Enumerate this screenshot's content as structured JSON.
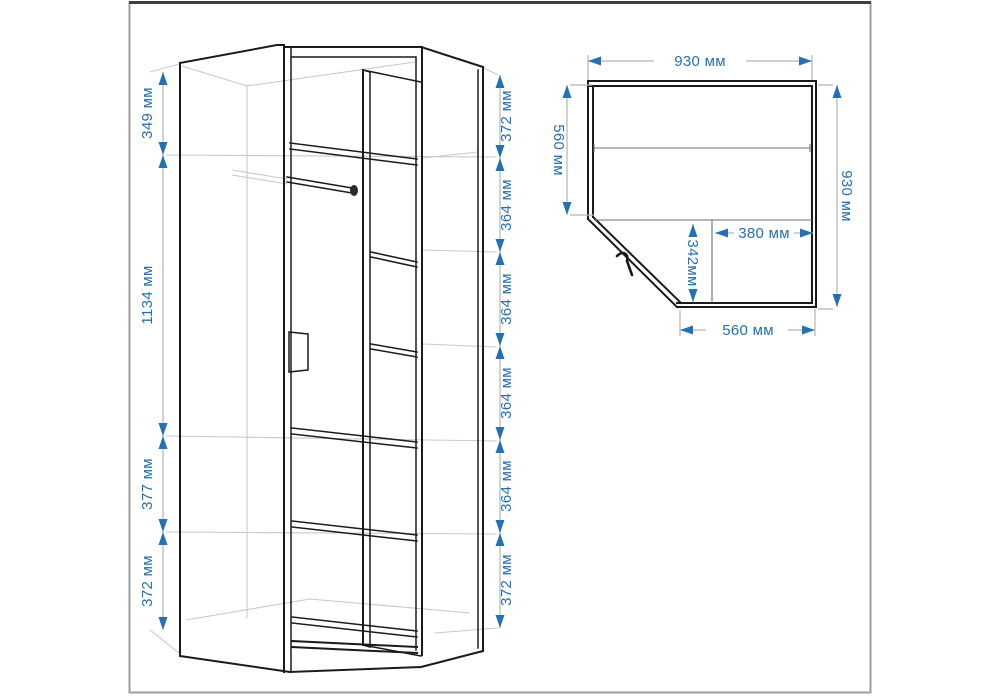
{
  "diagram_title": "corner-wardrobe-dimension-drawing",
  "units": "мм",
  "colors": {
    "dimension_accent": "#2470b3",
    "drawing_line": "#1b1b1b",
    "hidden_line": "#c9c9c9",
    "frame": "#9c9c9c"
  },
  "front_view": {
    "name": "wardrobe front perspective view",
    "left_dims": [
      "349 мм",
      "1134 мм",
      "377 мм",
      "372 мм"
    ],
    "right_dims": [
      "372 мм",
      "364 мм",
      "364 мм",
      "364 мм",
      "364 мм",
      "372 мм"
    ]
  },
  "plan_view": {
    "name": "wardrobe top plan view",
    "top_width": "930 мм",
    "left_depth": "560 мм",
    "right_depth": "930 мм",
    "inner_width": "380 мм",
    "inner_depth": "342мм",
    "bottom_width": "560 мм"
  }
}
